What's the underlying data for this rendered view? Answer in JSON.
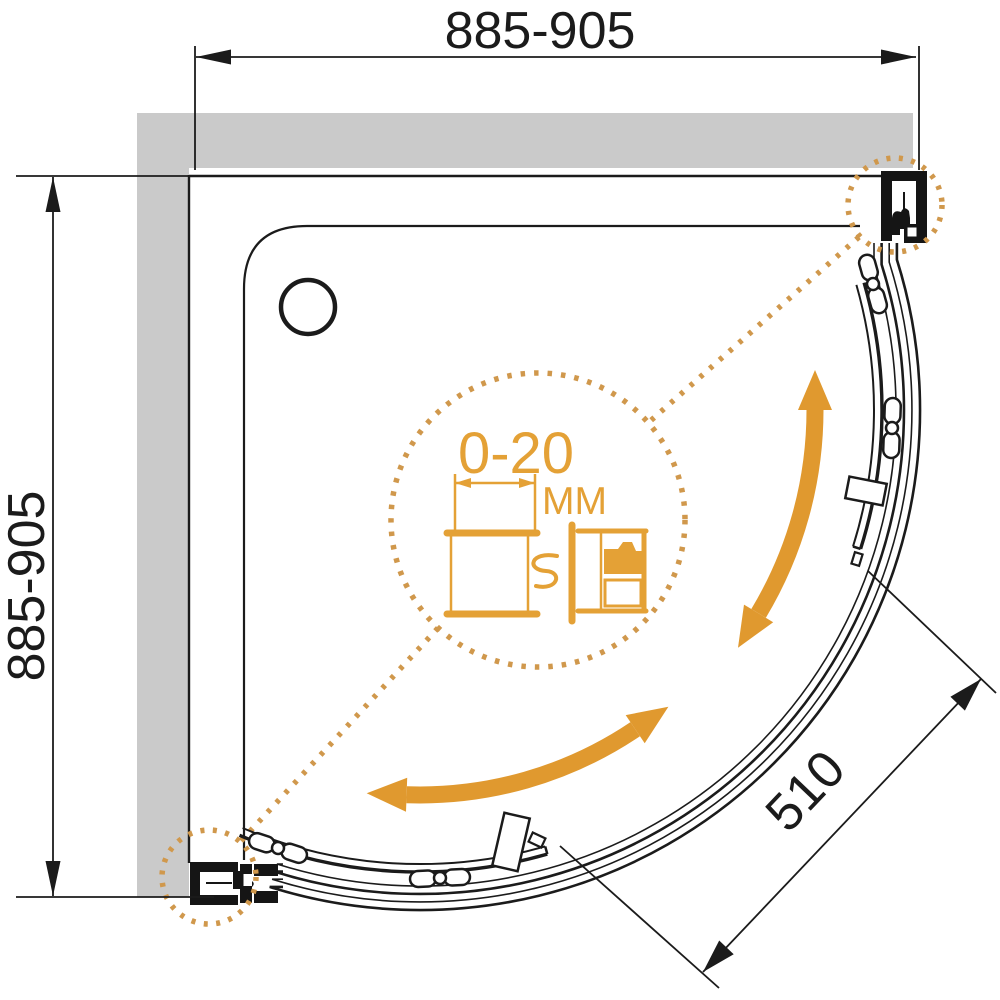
{
  "drawing": {
    "type": "technical-plan-view",
    "subject": "quadrant corner shower enclosure with curved sliding doors",
    "dimensions": {
      "top_width": "885-905",
      "side_depth": "885-905",
      "entry_width": "510",
      "adjustment_range": "0-20",
      "adjustment_unit": "MM"
    },
    "colors": {
      "line": "#1b1b1b",
      "wall_gray": "#cacaca",
      "accent_orange": "#e0992f",
      "dashed_orange": "#d0984c",
      "detail_orange": "#e4a136"
    }
  }
}
